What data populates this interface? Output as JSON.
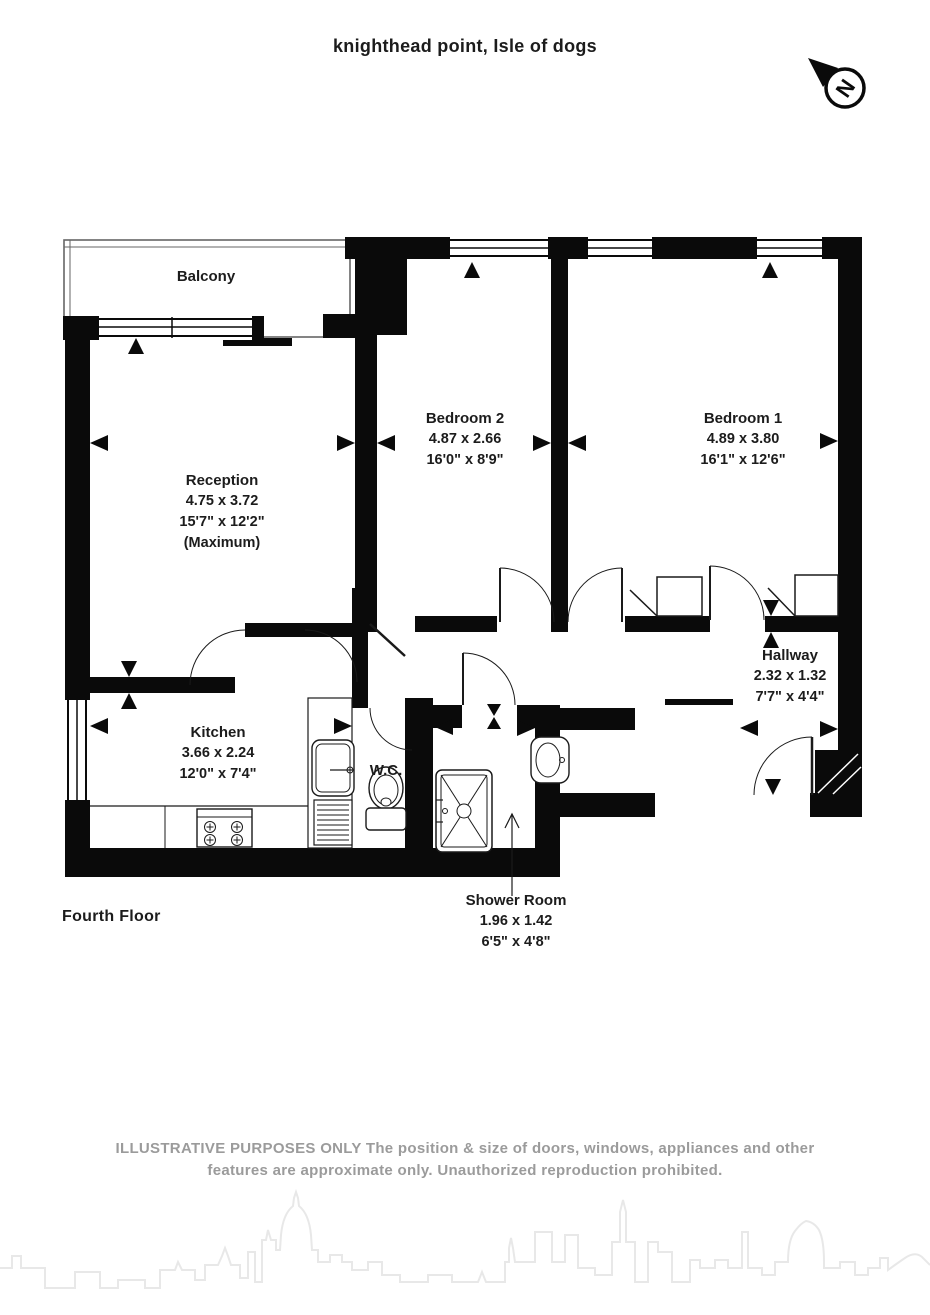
{
  "page": {
    "title": "knighthead point, Isle of dogs",
    "floor": "Fourth Floor"
  },
  "compass": {
    "letter": "N"
  },
  "rooms": {
    "balcony": {
      "name": "Balcony"
    },
    "reception": {
      "name": "Reception",
      "metric": "4.75 x 3.72",
      "imperial": "15'7\" x 12'2\"",
      "note": "(Maximum)"
    },
    "bedroom2": {
      "name": "Bedroom 2",
      "metric": "4.87 x 2.66",
      "imperial": "16'0\" x 8'9\""
    },
    "bedroom1": {
      "name": "Bedroom 1",
      "metric": "4.89 x 3.80",
      "imperial": "16'1\" x 12'6\""
    },
    "hallway": {
      "name": "Hallway",
      "metric": "2.32 x 1.32",
      "imperial": "7'7\" x 4'4\""
    },
    "kitchen": {
      "name": "Kitchen",
      "metric": "3.66 x 2.24",
      "imperial": "12'0\" x 7'4\""
    },
    "wc": {
      "name": "W.C."
    },
    "shower": {
      "name": "Shower Room",
      "metric": "1.96 x 1.42",
      "imperial": "6'5\" x 4'8\""
    }
  },
  "disclaimer": {
    "line1": "ILLUSTRATIVE PURPOSES ONLY  The position & size of doors, windows, appliances and other",
    "line2": "features are approximate only. Unauthorized reproduction prohibited."
  },
  "colors": {
    "wall": "#0a0a0a",
    "text": "#1c1c1c",
    "disclaimer": "#9b9b9b",
    "skyline": "#e8e8e8"
  }
}
